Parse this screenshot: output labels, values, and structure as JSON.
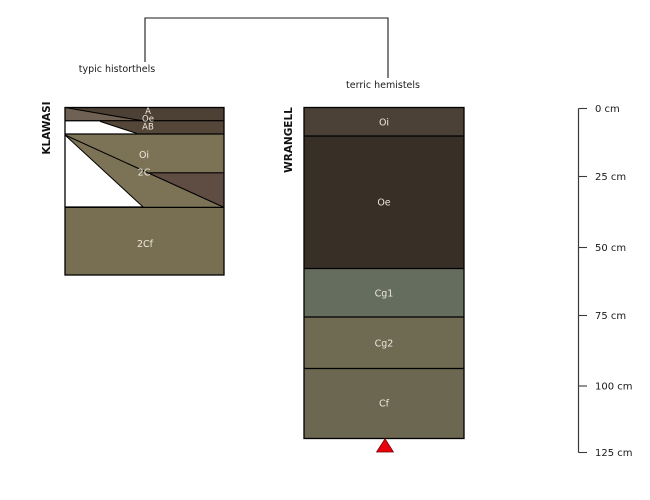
{
  "figure": {
    "type": "soil-profile-diagram",
    "classification_labels": {
      "left": "typic historthels",
      "right": "terric hemistels"
    }
  },
  "profiles": [
    {
      "name": "KLAWASI",
      "classification": "typic historthels",
      "horizons": [
        "A",
        "Oe",
        "AB",
        "Oi",
        "2C",
        "2Cf"
      ]
    },
    {
      "name": "WRANGELL",
      "classification": "terric hemistels",
      "horizons": [
        "Oi",
        "Oe",
        "Cg1",
        "Cg2",
        "Cf"
      ]
    }
  ],
  "depth_scale": {
    "unit": "cm",
    "ticks": [
      "0 cm",
      "25 cm",
      "50 cm",
      "75 cm",
      "100 cm",
      "125 cm"
    ]
  },
  "colors": {
    "klawasi_a": "#4d4034",
    "klawasi_oe": "#6f6153",
    "klawasi_ab": "#544639",
    "klawasi_oi": "#7c7357",
    "klawasi_2c": "#5f4c42",
    "klawasi_2cf": "#786f53",
    "wrangell_oi": "#4c4136",
    "wrangell_oe": "#382f27",
    "wrangell_cg1": "#646d5e",
    "wrangell_cg2": "#6f6a52",
    "wrangell_cf": "#6c6750",
    "unfilled_wedge": "#ffffff",
    "marker_red": "#e8000b",
    "horizon_label_text": "#ede8dd",
    "line": "#000000",
    "scale_line": "#3a3a3a"
  }
}
